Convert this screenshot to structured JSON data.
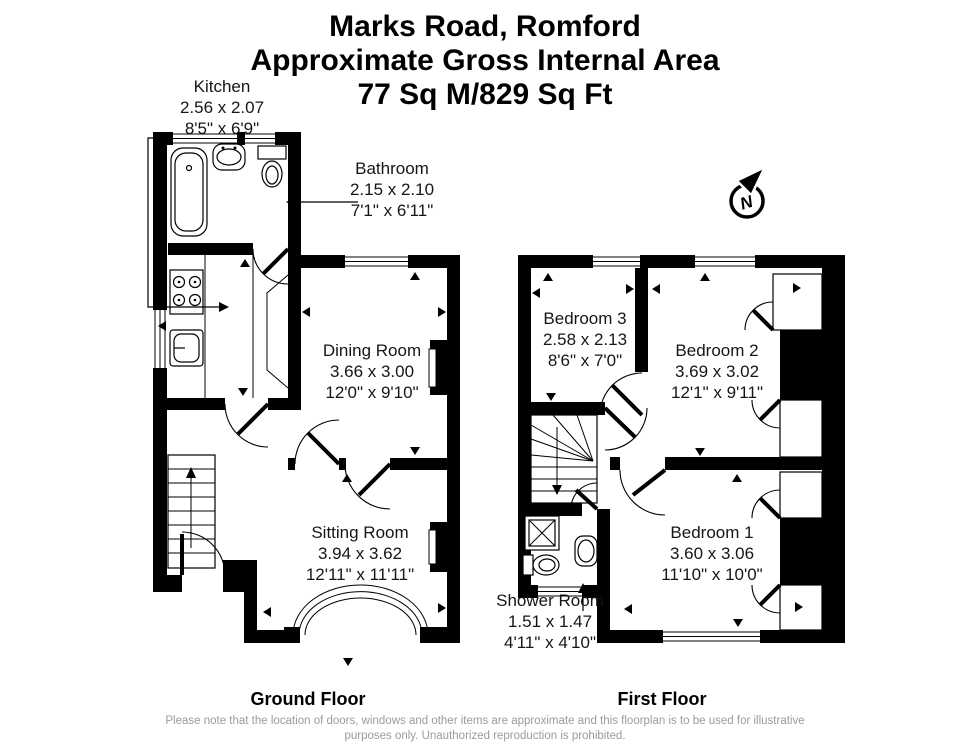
{
  "title": {
    "address": "Marks Road, Romford",
    "subtitle": "Approximate Gross Internal Area",
    "area": "77 Sq M/829 Sq Ft"
  },
  "compass": {
    "label": "N"
  },
  "floors": {
    "ground": {
      "caption": "Ground Floor",
      "rooms": {
        "kitchen": {
          "name": "Kitchen",
          "metric": "2.56 x 2.07",
          "imperial": "8'5\" x 6'9\""
        },
        "bathroom": {
          "name": "Bathroom",
          "metric": "2.15 x 2.10",
          "imperial": "7'1\" x 6'11\""
        },
        "dining": {
          "name": "Dining Room",
          "metric": "3.66 x 3.00",
          "imperial": "12'0\" x 9'10\""
        },
        "sitting": {
          "name": "Sitting Room",
          "metric": "3.94 x 3.62",
          "imperial": "12'11\" x 11'11\""
        }
      }
    },
    "first": {
      "caption": "First Floor",
      "rooms": {
        "bedroom3": {
          "name": "Bedroom 3",
          "metric": "2.58 x 2.13",
          "imperial": "8'6\" x 7'0\""
        },
        "bedroom2": {
          "name": "Bedroom 2",
          "metric": "3.69 x 3.02",
          "imperial": "12'1\" x 9'11\""
        },
        "bedroom1": {
          "name": "Bedroom 1",
          "metric": "3.60 x 3.06",
          "imperial": "11'10\" x 10'0\""
        },
        "shower": {
          "name": "Shower Room",
          "metric": "1.51 x 1.47",
          "imperial": "4'11\" x 4'10\""
        }
      }
    }
  },
  "footer": {
    "line1": "Please note that the location of doors, windows and other items are approximate and this floorplan is to be used for illustrative",
    "line2": "purposes only. Unauthorized reproduction is prohibited."
  },
  "colors": {
    "wall": "#000000",
    "label": "#161616",
    "disclaimer": "#9b9b9b"
  }
}
